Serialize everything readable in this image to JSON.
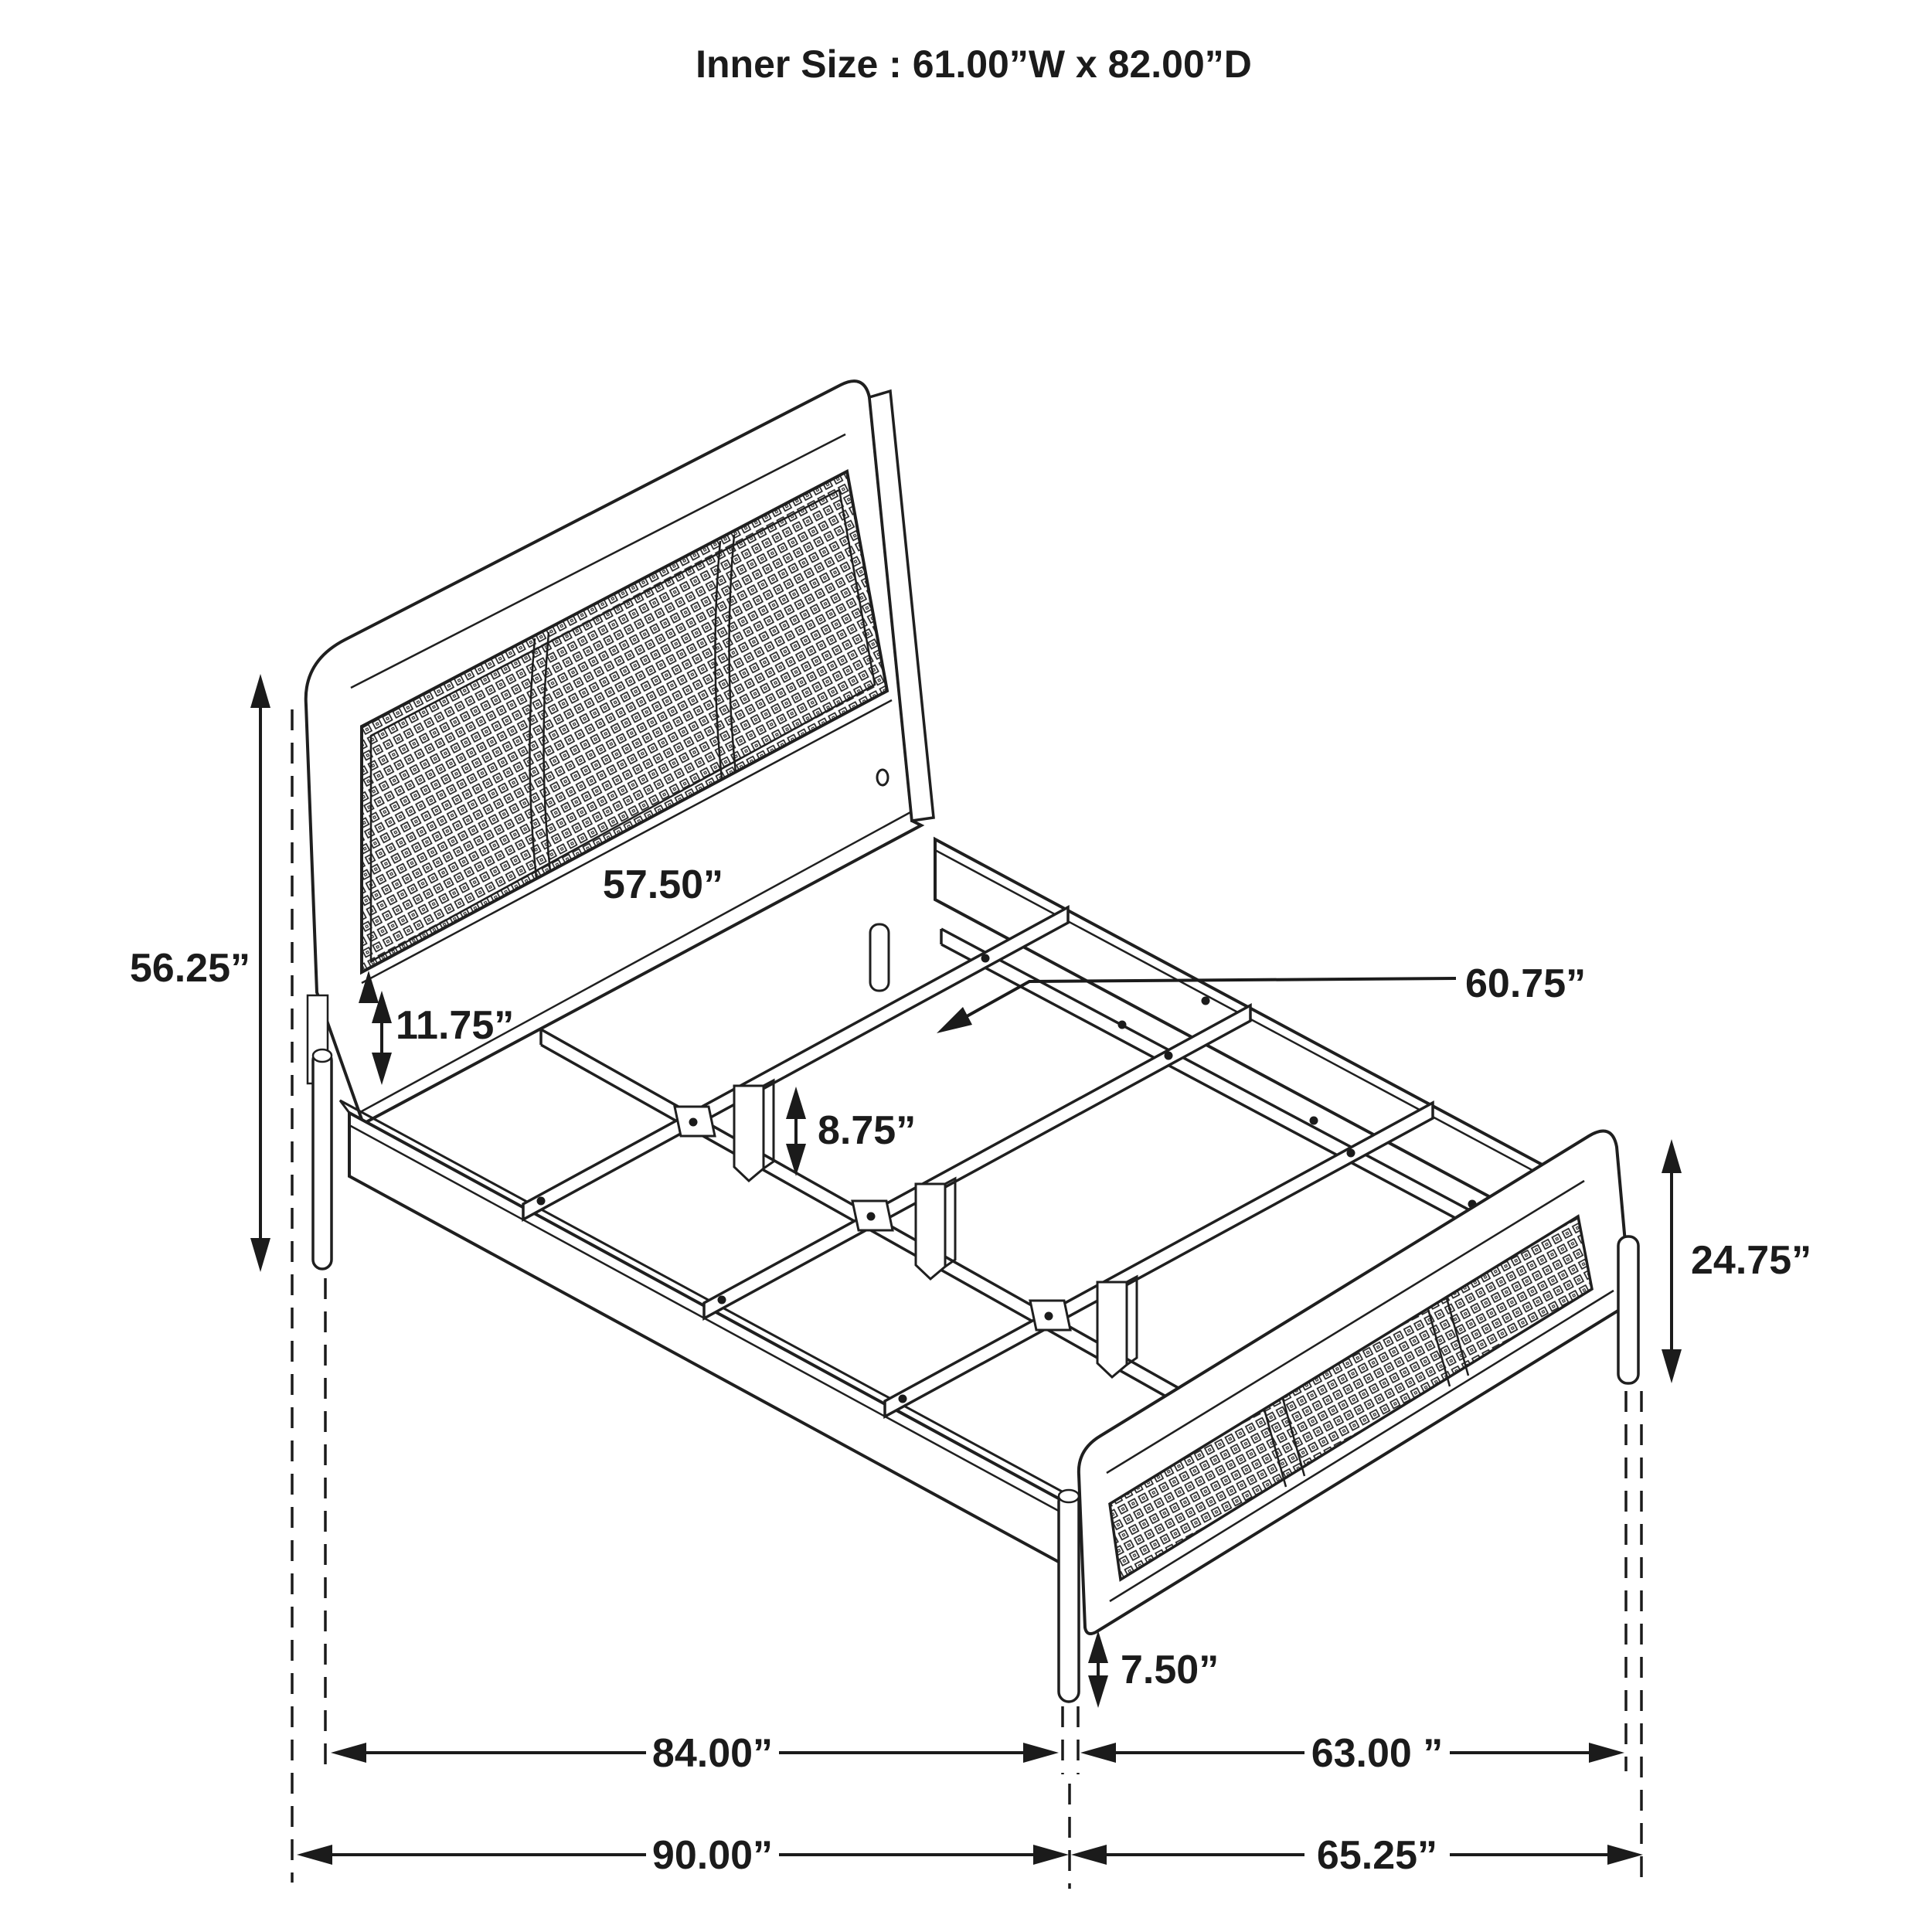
{
  "colors": {
    "background": "#ffffff",
    "ink": "#1b1b1b"
  },
  "title": "Inner Size : 61.00”W x 82.00”D",
  "dims": {
    "headboard_height": "56.25”",
    "headboard_width": "57.50”",
    "headboard_rail_height": "11.75”",
    "center_leg_height": "8.75”",
    "slat_rail_length": "60.75”",
    "footboard_height": "24.75”",
    "footboard_leg_height": "7.50”",
    "frame_inner_length": "84.00”",
    "footboard_inner_width": "63.00 ”",
    "frame_overall_length": "90.00”",
    "footboard_overall_width": "65.25”"
  }
}
